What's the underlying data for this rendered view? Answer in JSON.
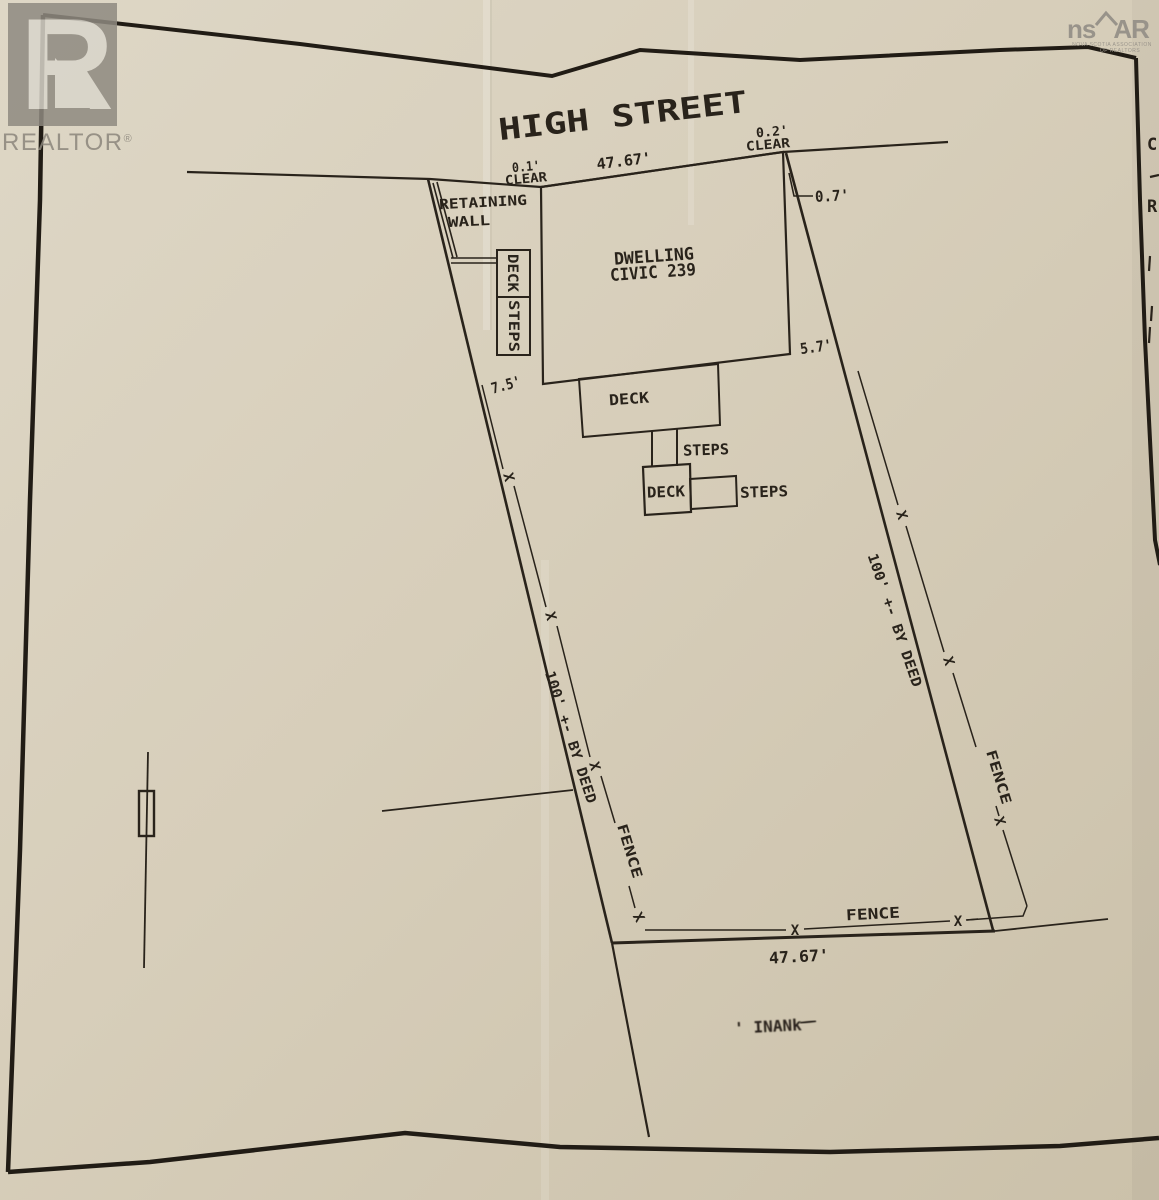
{
  "watermark": {
    "glyph": "R",
    "wordmark": "REALTOR",
    "registered": "®"
  },
  "nsar_logo": {
    "ns": "ns",
    "ar": "AR",
    "subtext1": "NOVA SCOTIA ASSOCIATION",
    "subtext2": "OF REALTORS"
  },
  "street_title": "HIGH STREET",
  "dwelling": {
    "line1": "DWELLING",
    "line2": "CIVIC 239"
  },
  "retaining_wall": {
    "line1": "RETAINING",
    "line2": "WALL"
  },
  "entry_box": {
    "deck": "DECK",
    "steps": "STEPS"
  },
  "rear": {
    "deck_label": "DECK",
    "steps_label": "STEPS",
    "small_deck_label": "DECK",
    "small_steps_label": "STEPS"
  },
  "dimensions": {
    "frontage_top": "47.67'",
    "frontage_bottom": "47.67'",
    "clear_left_value": "0.1'",
    "clear_left_word": "CLEAR",
    "clear_right_value": "0.2'",
    "clear_right_word": "CLEAR",
    "corner_offset": "0.7'",
    "rear_offset": "5.7'",
    "front_offset": "7.5'",
    "left_depth": "100' +- BY DEED",
    "right_depth": "100' +- BY DEED"
  },
  "fence": {
    "left": "FENCE",
    "right": "FENCE",
    "bottom": "FENCE",
    "x_mark": "X"
  },
  "handwriting": "' INANk",
  "edge_text": {
    "c": "C",
    "r": "R"
  }
}
